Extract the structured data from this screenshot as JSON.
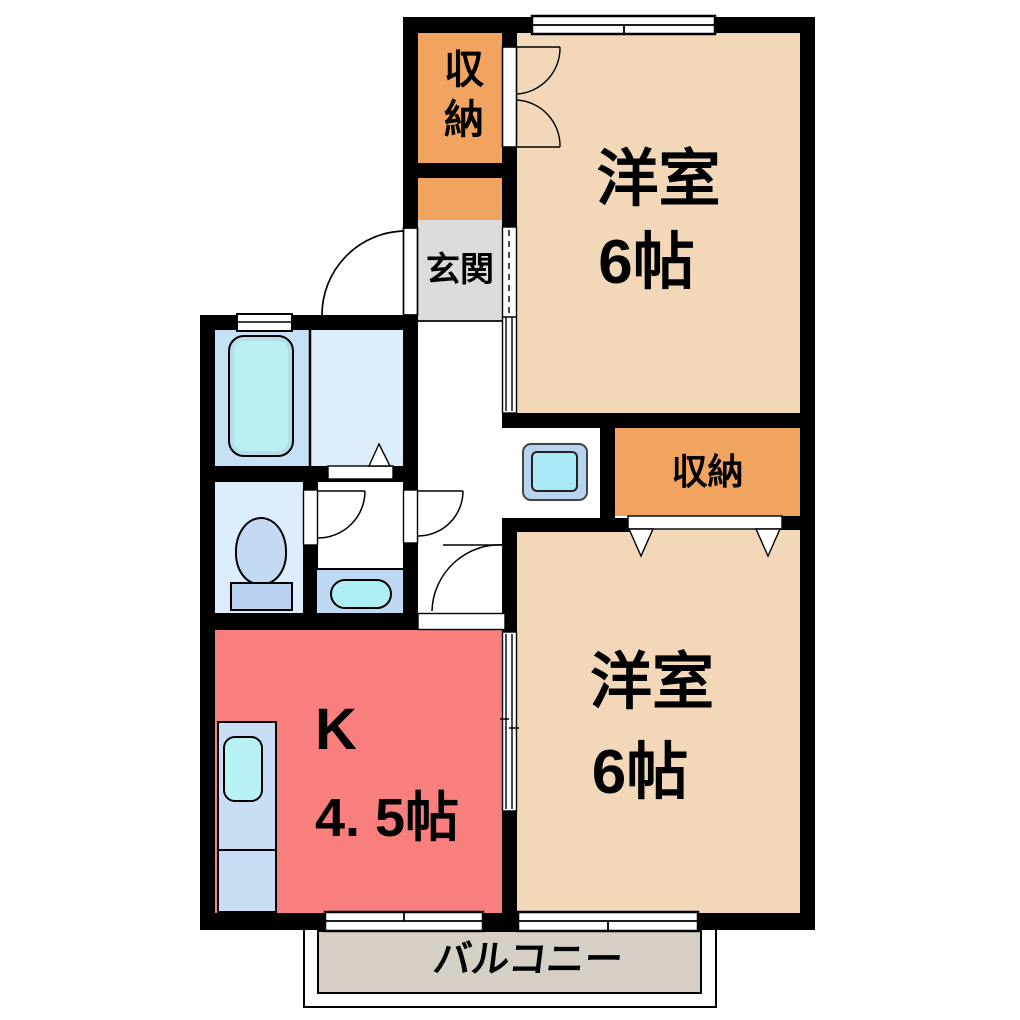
{
  "floorplan": {
    "rooms": {
      "bedroom1": {
        "name": "洋室",
        "size": "6帖"
      },
      "bedroom2": {
        "name": "洋室",
        "size": "6帖"
      },
      "kitchen": {
        "name": "K",
        "size": "4. 5帖"
      },
      "entrance": {
        "label": "玄関"
      },
      "closet1": {
        "label": "収納"
      },
      "closet2": {
        "label": "収納"
      },
      "balcony": {
        "label": "バルコニー"
      }
    },
    "colors": {
      "wall": "#000000",
      "western_room": "#f2d8b8",
      "closet": "#f0a45f",
      "kitchen": "#f97f7f",
      "entrance": "#dcdcdc",
      "balcony": "#d6cfc6",
      "bath_room": "#c6e0f5",
      "water_room": "#dcedfb",
      "fixture_blue": "#c3daf2",
      "water_cyan": "#b4eff2"
    }
  }
}
